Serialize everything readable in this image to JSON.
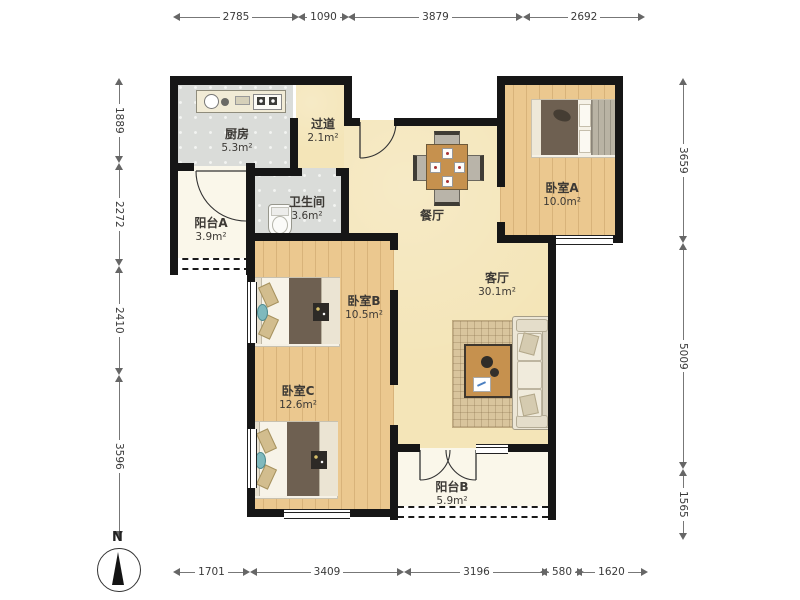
{
  "compass": {
    "north_label": "N"
  },
  "rooms": {
    "kitchen": {
      "name": "厨房",
      "area": "5.3m²"
    },
    "hallway": {
      "name": "过道",
      "area": "2.1m²"
    },
    "bathroom": {
      "name": "卫生间",
      "area": "3.6m²"
    },
    "balcony_a": {
      "name": "阳台A",
      "area": "3.9m²"
    },
    "bedroom_a": {
      "name": "卧室A",
      "area": "10.0m²"
    },
    "dining": {
      "name": "餐厅"
    },
    "living": {
      "name": "客厅",
      "area": "30.1m²"
    },
    "bedroom_b": {
      "name": "卧室B",
      "area": "10.5m²"
    },
    "bedroom_c": {
      "name": "卧室C",
      "area": "12.6m²"
    },
    "balcony_b": {
      "name": "阳台B",
      "area": "5.9m²"
    }
  },
  "dimensions": {
    "top": [
      "2785",
      "1090",
      "3879",
      "2692"
    ],
    "bottom": [
      "1701",
      "3409",
      "3196",
      "580",
      "1620"
    ],
    "left": [
      "1889",
      "2272",
      "2410",
      "3596"
    ],
    "right": [
      "3659",
      "5009",
      "1565"
    ]
  },
  "colors": {
    "wall": "#161616",
    "wood": "#ebc88f",
    "tile": "#dadcd9",
    "cream": "#f4e5b8",
    "balcony": "#faf7ea"
  }
}
